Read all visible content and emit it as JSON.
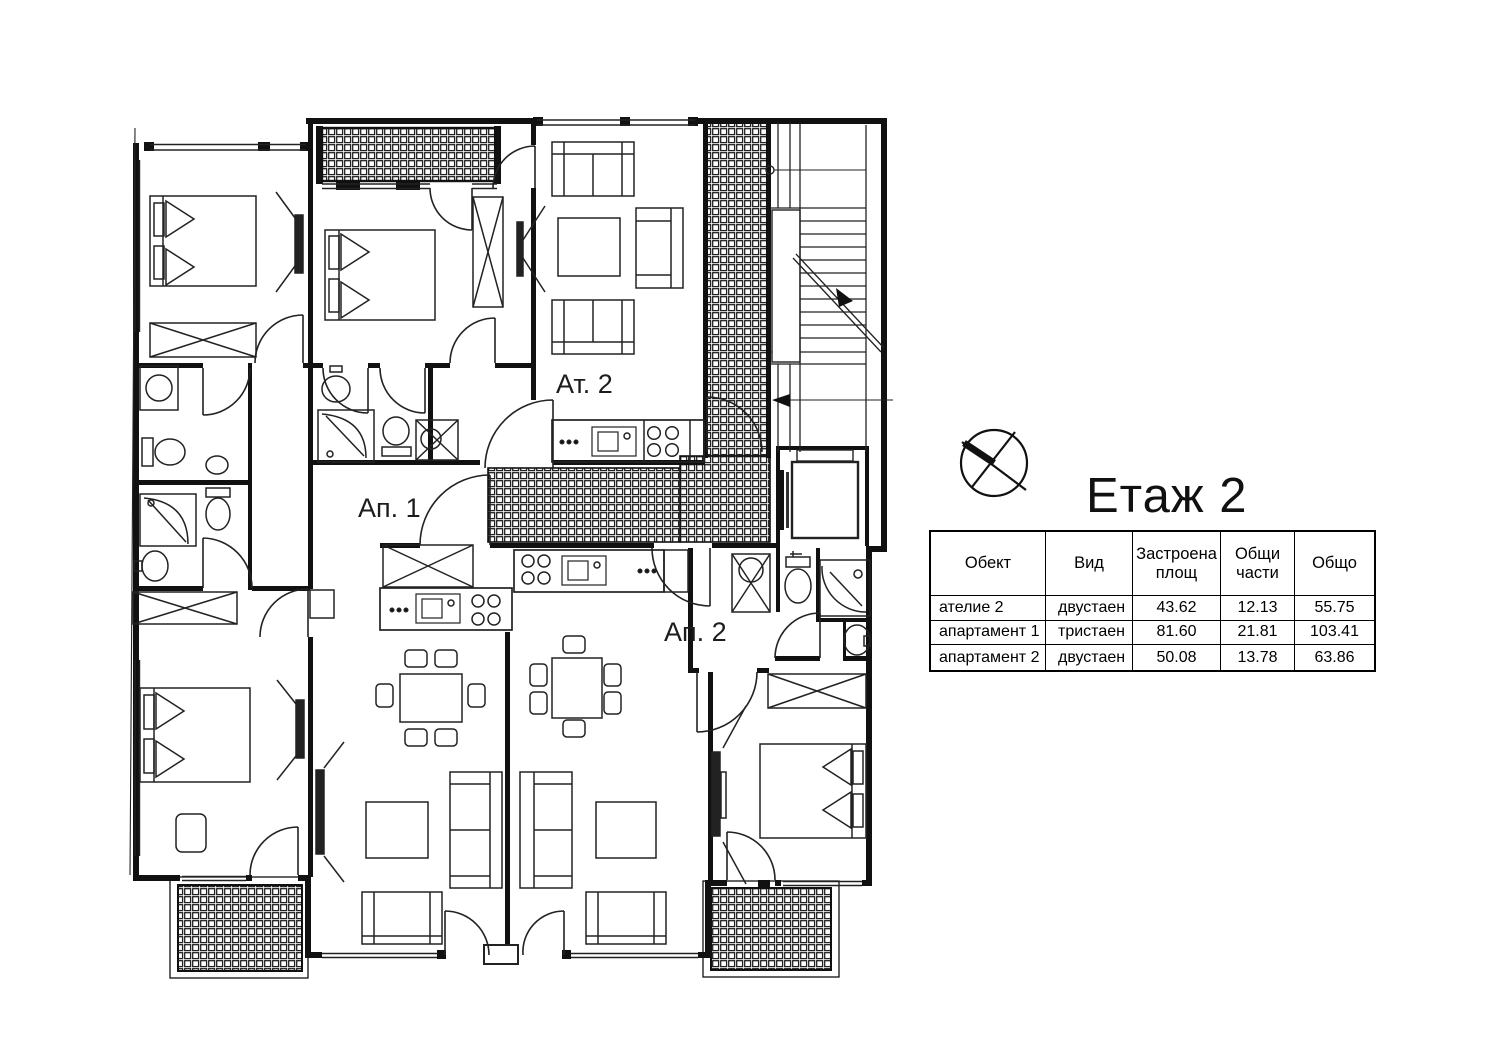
{
  "floor_plan": {
    "unit_labels": {
      "atelier_2": "Ат. 2",
      "apartment_1": "Ап. 1",
      "apartment_2": "Ап. 2"
    }
  },
  "legend": {
    "title": "Етаж 2",
    "north_icon": "compass-north-arrow-icon"
  },
  "summary_table": {
    "headers": [
      "Обект",
      "Вид",
      "Застроена площ",
      "Общи части",
      "Общо"
    ],
    "rows": [
      [
        "ателие 2",
        "двустаен",
        "43.62",
        "12.13",
        "55.75"
      ],
      [
        "апартамент 1",
        "тристаен",
        "81.60",
        "21.81",
        "103.41"
      ],
      [
        "апартамент 2",
        "двустаен",
        "50.08",
        "13.78",
        "63.86"
      ]
    ]
  }
}
